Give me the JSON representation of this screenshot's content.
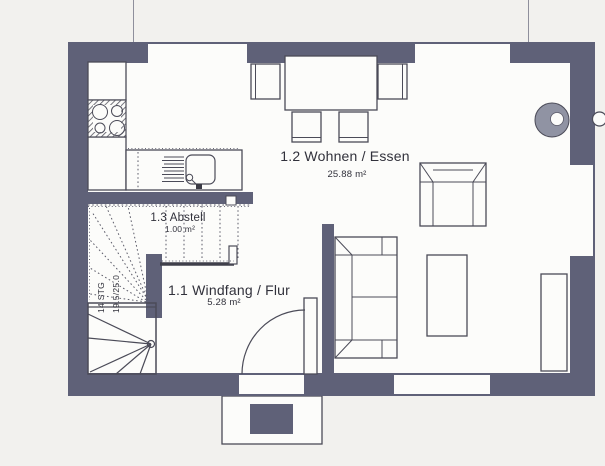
{
  "plan": {
    "rooms": [
      {
        "number": "1.2",
        "name": "1.2 Wohnen / Essen",
        "area": "25.88 m²"
      },
      {
        "number": "1.3",
        "name": "1.3 Abstell",
        "area": "1.00 m²"
      },
      {
        "number": "1.1",
        "name": "1.1 Windfang / Flur",
        "area": "5.28 m²"
      }
    ],
    "stairs": {
      "steps": "14 STG",
      "rise_run": "19.5/25.0"
    }
  },
  "colors": {
    "paper": "#f2f1ee",
    "floor": "#fcfcfa",
    "wall": "#5f6178",
    "line": "#4b4b58",
    "chimney": "#9093a3",
    "text": "#31313b"
  },
  "icons": {
    "furniture": [
      "stove-icon",
      "sink-icon",
      "kitchen-counter",
      "dining-table",
      "dining-chair",
      "armchair",
      "sofa",
      "coffee-table",
      "sideboard",
      "chimney-icon",
      "stairs-icon",
      "entry-door",
      "door-mat",
      "porch"
    ]
  }
}
